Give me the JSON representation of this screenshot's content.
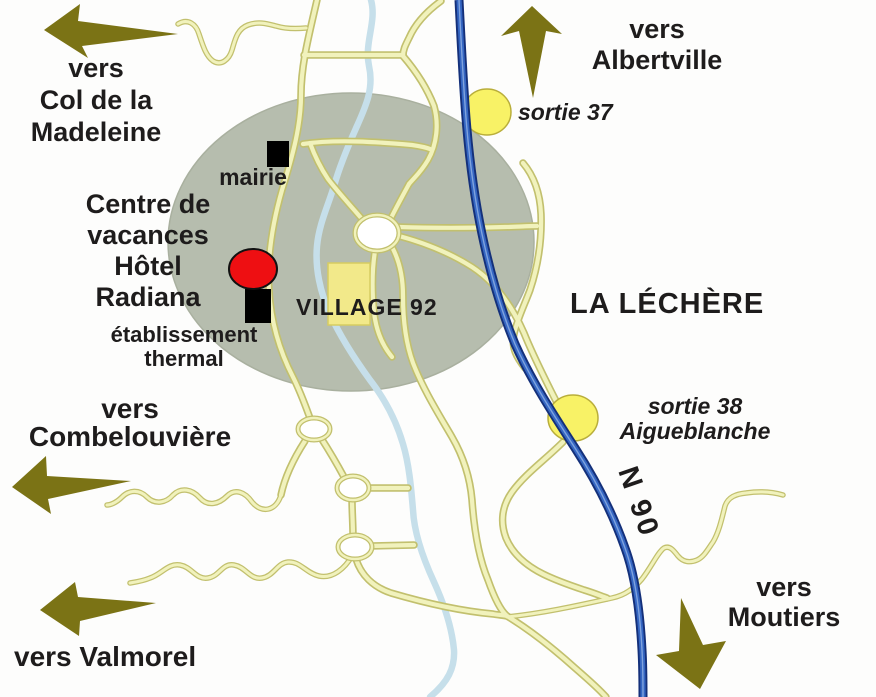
{
  "labels": {
    "direction_madeleine": [
      "vers",
      "Col de la",
      "Madeleine"
    ],
    "direction_albertville": [
      "vers",
      "Albertville"
    ],
    "exit_37": "sortie 37",
    "town_hall": "mairie",
    "holiday_center": [
      "Centre de",
      "vacances",
      "Hôtel",
      "Radiana"
    ],
    "thermal_establishment": [
      "établissement",
      "thermal"
    ],
    "village_92": "VILLAGE 92",
    "la_lechere": "LA LÉCHÈRE",
    "direction_combelouviere": [
      "vers",
      "Combelouvière"
    ],
    "direction_valmorel": "vers Valmorel",
    "exit_38": [
      "sortie 38",
      "Aigueblanche"
    ],
    "road_n90": "N 90",
    "direction_moutiers": [
      "vers",
      "Moutiers"
    ]
  },
  "markers": {
    "mairie_building": "black-square",
    "thermal_building": "black-square",
    "hotel_radiana": "red-ellipse",
    "village_92_site": "yellow-rectangle",
    "exit_37_junction": "yellow-ellipse",
    "exit_38_junction": "yellow-ellipse",
    "roundabouts": "white-ellipse-ring",
    "urban_area": "gray-ellipse"
  },
  "icons": {
    "direction_arrows": [
      "arrow-up-left-madeleine",
      "arrow-up-albertville",
      "arrow-left-combelouviere",
      "arrow-left-valmorel",
      "arrow-down-right-moutiers"
    ]
  },
  "colors": {
    "background": "#FDFDFC",
    "urban_area": "#B6BDAE",
    "road_fill": "#F1F2BC",
    "road_casing": "#C2C06E",
    "river": "#C6DFEA",
    "highway_outer": "#14307A",
    "highway_inner": "#3566C2",
    "exit_marker": "#F8F266",
    "village_marker": "#F2E98A",
    "hotel_marker": "#EE0F12",
    "building_marker": "#000000",
    "arrow": "#7B7315",
    "text": "#1E1C1C"
  }
}
